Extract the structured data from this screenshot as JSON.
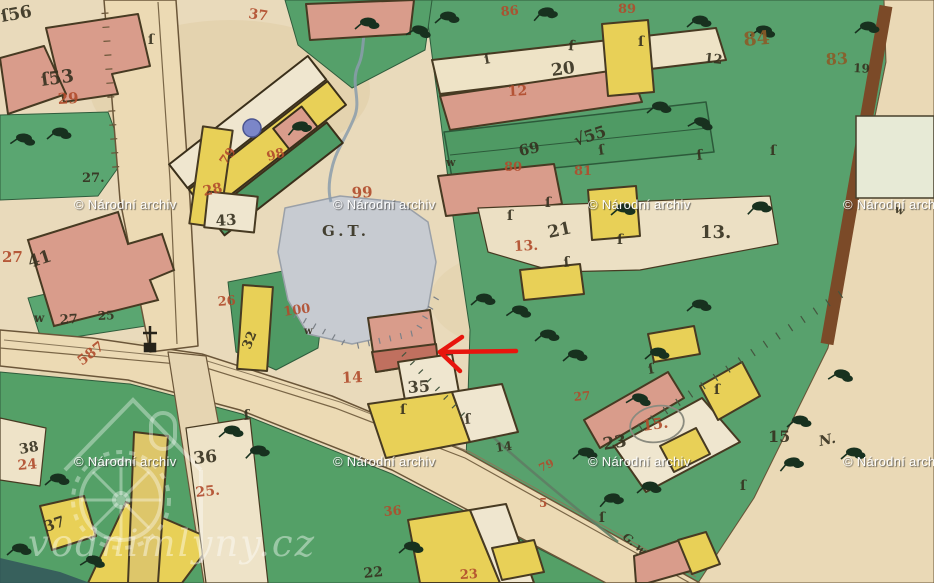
{
  "watermarks": {
    "archive_text": "© Národní archiv",
    "archive_positions": [
      [
        74,
        197
      ],
      [
        333,
        197
      ],
      [
        588,
        197
      ],
      [
        843,
        197
      ],
      [
        74,
        454
      ],
      [
        333,
        454
      ],
      [
        588,
        454
      ],
      [
        843,
        454
      ]
    ],
    "site_text": "vodnimlyny.cz"
  },
  "annotations": {
    "arrow": {
      "tip_x": 440,
      "tip_y": 352,
      "tail_x": 516,
      "tail_y": 351,
      "color": "#e8150d"
    }
  },
  "colors": {
    "ink": "#35301f",
    "red": "#b14c2c",
    "brown": "#8c5c28",
    "paper": "#e9dabb",
    "meadow": "#58a16d",
    "water": "#c7cbd1",
    "masonry": "#d99c8b",
    "wood": "#e8d057",
    "road": "#ecdab4",
    "blue_dot": "#7b86c8",
    "arrow": "#e8150d",
    "watermark": "#ffffff"
  },
  "map_labels": [
    {
      "t": "ſ56",
      "x": 2,
      "y": 22,
      "c": "ink",
      "s": 17,
      "r": -10
    },
    {
      "t": "ſ53",
      "x": 42,
      "y": 86,
      "c": "ink",
      "s": 18,
      "r": -8
    },
    {
      "t": "27.",
      "x": 82,
      "y": 182,
      "c": "ink",
      "s": 13,
      "r": 0
    },
    {
      "t": "41",
      "x": 30,
      "y": 268,
      "c": "ink",
      "s": 17,
      "r": -18
    },
    {
      "t": "w",
      "x": 34,
      "y": 322,
      "c": "ink",
      "s": 12,
      "r": 0
    },
    {
      "t": "27",
      "x": 60,
      "y": 324,
      "c": "ink",
      "s": 13,
      "r": -3
    },
    {
      "t": "25",
      "x": 98,
      "y": 320,
      "c": "ink",
      "s": 12,
      "r": -3
    },
    {
      "t": "20",
      "x": 552,
      "y": 76,
      "c": "ink",
      "s": 17,
      "r": -8
    },
    {
      "t": "12",
      "x": 704,
      "y": 62,
      "c": "ink",
      "s": 13,
      "r": 6
    },
    {
      "t": "19",
      "x": 853,
      "y": 72,
      "c": "ink",
      "s": 12,
      "r": 3
    },
    {
      "t": "13.",
      "x": 700,
      "y": 238,
      "c": "ink",
      "s": 18,
      "r": 0
    },
    {
      "t": "21",
      "x": 549,
      "y": 238,
      "c": "ink",
      "s": 17,
      "r": -12
    },
    {
      "t": "√55",
      "x": 576,
      "y": 146,
      "c": "ink",
      "s": 16,
      "r": -18
    },
    {
      "t": "69",
      "x": 520,
      "y": 156,
      "c": "ink",
      "s": 15,
      "r": -12
    },
    {
      "t": "43",
      "x": 216,
      "y": 226,
      "c": "ink",
      "s": 15,
      "r": -4
    },
    {
      "t": "32",
      "x": 250,
      "y": 350,
      "c": "ink",
      "s": 13,
      "r": -68
    },
    {
      "t": "35",
      "x": 408,
      "y": 393,
      "c": "ink",
      "s": 16,
      "r": -4
    },
    {
      "t": "G.T.",
      "x": 322,
      "y": 236,
      "c": "ink",
      "s": 15,
      "r": 0
    },
    {
      "t": "38",
      "x": 20,
      "y": 454,
      "c": "ink",
      "s": 14,
      "r": -10
    },
    {
      "t": "36",
      "x": 194,
      "y": 464,
      "c": "ink",
      "s": 17,
      "r": -6
    },
    {
      "t": "37",
      "x": 46,
      "y": 532,
      "c": "ink",
      "s": 15,
      "r": -18
    },
    {
      "t": "22",
      "x": 364,
      "y": 578,
      "c": "ink",
      "s": 14,
      "r": -6
    },
    {
      "t": "23",
      "x": 604,
      "y": 450,
      "c": "ink",
      "s": 17,
      "r": -10
    },
    {
      "t": "15",
      "x": 768,
      "y": 442,
      "c": "ink",
      "s": 16,
      "r": 0
    },
    {
      "t": "14",
      "x": 496,
      "y": 452,
      "c": "ink",
      "s": 12,
      "r": -8
    },
    {
      "t": "N.",
      "x": 820,
      "y": 446,
      "c": "ink",
      "s": 14,
      "r": -12,
      "i": 1
    },
    {
      "t": "G. w",
      "x": 622,
      "y": 538,
      "c": "ink",
      "s": 11,
      "r": 40,
      "i": 1
    },
    {
      "t": "w",
      "x": 446,
      "y": 166,
      "c": "ink",
      "s": 11,
      "r": 0
    },
    {
      "t": "w",
      "x": 894,
      "y": 212,
      "c": "ink",
      "s": 11,
      "r": 20
    },
    {
      "t": "w",
      "x": 304,
      "y": 334,
      "c": "ink",
      "s": 10,
      "r": 0
    },
    {
      "t": "ſ",
      "x": 485,
      "y": 64,
      "c": "ink",
      "s": 14,
      "r": -10
    },
    {
      "t": "ſ",
      "x": 568,
      "y": 50,
      "c": "ink",
      "s": 14,
      "r": 5
    },
    {
      "t": "ſ",
      "x": 638,
      "y": 46,
      "c": "ink",
      "s": 14,
      "r": 0
    },
    {
      "t": "ſ",
      "x": 599,
      "y": 155,
      "c": "ink",
      "s": 14,
      "r": -8
    },
    {
      "t": "ſ",
      "x": 545,
      "y": 207,
      "c": "ink",
      "s": 14,
      "r": 0
    },
    {
      "t": "ſ",
      "x": 507,
      "y": 220,
      "c": "ink",
      "s": 14,
      "r": 0
    },
    {
      "t": "ſ",
      "x": 564,
      "y": 267,
      "c": "ink",
      "s": 14,
      "r": -5
    },
    {
      "t": "ſ",
      "x": 617,
      "y": 244,
      "c": "ink",
      "s": 14,
      "r": 0
    },
    {
      "t": "ſ",
      "x": 697,
      "y": 160,
      "c": "ink",
      "s": 14,
      "r": -6
    },
    {
      "t": "ſ",
      "x": 770,
      "y": 155,
      "c": "ink",
      "s": 14,
      "r": 0
    },
    {
      "t": "ſ",
      "x": 400,
      "y": 414,
      "c": "ink",
      "s": 14,
      "r": 0
    },
    {
      "t": "ſ",
      "x": 465,
      "y": 424,
      "c": "ink",
      "s": 14,
      "r": -5
    },
    {
      "t": "ſ",
      "x": 599,
      "y": 522,
      "c": "ink",
      "s": 14,
      "r": 0
    },
    {
      "t": "ſ",
      "x": 740,
      "y": 490,
      "c": "ink",
      "s": 14,
      "r": 0
    },
    {
      "t": "ſ",
      "x": 714,
      "y": 394,
      "c": "ink",
      "s": 14,
      "r": 0
    },
    {
      "t": "ſ",
      "x": 649,
      "y": 374,
      "c": "ink",
      "s": 14,
      "r": -10
    },
    {
      "t": "ſ",
      "x": 148,
      "y": 44,
      "c": "ink",
      "s": 14,
      "r": 0
    },
    {
      "t": "ſ",
      "x": 244,
      "y": 420,
      "c": "ink",
      "s": 14,
      "r": -5
    },
    {
      "t": "37",
      "x": 248,
      "y": 18,
      "c": "red",
      "s": 14,
      "r": 8
    },
    {
      "t": "86",
      "x": 501,
      "y": 16,
      "c": "red",
      "s": 13,
      "r": -5
    },
    {
      "t": "89",
      "x": 618,
      "y": 13,
      "c": "red",
      "s": 13,
      "r": 0
    },
    {
      "t": "12",
      "x": 508,
      "y": 96,
      "c": "red",
      "s": 14,
      "r": -3
    },
    {
      "t": "80",
      "x": 504,
      "y": 171,
      "c": "red",
      "s": 13,
      "r": 0
    },
    {
      "t": "81",
      "x": 574,
      "y": 175,
      "c": "red",
      "s": 13,
      "r": 0
    },
    {
      "t": "29",
      "x": 58,
      "y": 104,
      "c": "red",
      "s": 15,
      "r": -3
    },
    {
      "t": "27",
      "x": 2,
      "y": 262,
      "c": "red",
      "s": 15,
      "r": 0
    },
    {
      "t": "587",
      "x": 82,
      "y": 366,
      "c": "red",
      "s": 14,
      "r": -38
    },
    {
      "t": "28",
      "x": 204,
      "y": 196,
      "c": "red",
      "s": 14,
      "r": -12
    },
    {
      "t": "98",
      "x": 268,
      "y": 161,
      "c": "red",
      "s": 13,
      "r": -15
    },
    {
      "t": "79",
      "x": 226,
      "y": 166,
      "c": "red",
      "s": 13,
      "r": -55
    },
    {
      "t": "99",
      "x": 352,
      "y": 198,
      "c": "red",
      "s": 15,
      "r": -3
    },
    {
      "t": "100",
      "x": 284,
      "y": 316,
      "c": "red",
      "s": 13,
      "r": -8
    },
    {
      "t": "26",
      "x": 218,
      "y": 306,
      "c": "red",
      "s": 13,
      "r": -5
    },
    {
      "t": "13.",
      "x": 514,
      "y": 251,
      "c": "red",
      "s": 14,
      "r": -3
    },
    {
      "t": "14",
      "x": 342,
      "y": 383,
      "c": "red",
      "s": 15,
      "r": -3
    },
    {
      "t": "24",
      "x": 18,
      "y": 470,
      "c": "red",
      "s": 14,
      "r": -5
    },
    {
      "t": "25.",
      "x": 196,
      "y": 497,
      "c": "red",
      "s": 14,
      "r": -6
    },
    {
      "t": "36",
      "x": 384,
      "y": 516,
      "c": "red",
      "s": 13,
      "r": -5
    },
    {
      "t": "23",
      "x": 460,
      "y": 579,
      "c": "red",
      "s": 13,
      "r": -3
    },
    {
      "t": "5",
      "x": 539,
      "y": 507,
      "c": "red",
      "s": 12,
      "r": 0
    },
    {
      "t": "79",
      "x": 541,
      "y": 472,
      "c": "red",
      "s": 11,
      "r": -25
    },
    {
      "t": "15.",
      "x": 643,
      "y": 431,
      "c": "red",
      "s": 15,
      "r": -8
    },
    {
      "t": "27",
      "x": 574,
      "y": 401,
      "c": "red",
      "s": 12,
      "r": -5
    },
    {
      "t": "84",
      "x": 744,
      "y": 46,
      "c": "brown",
      "s": 19,
      "r": -5
    },
    {
      "t": "83",
      "x": 826,
      "y": 65,
      "c": "brown",
      "s": 16,
      "r": -3
    }
  ]
}
